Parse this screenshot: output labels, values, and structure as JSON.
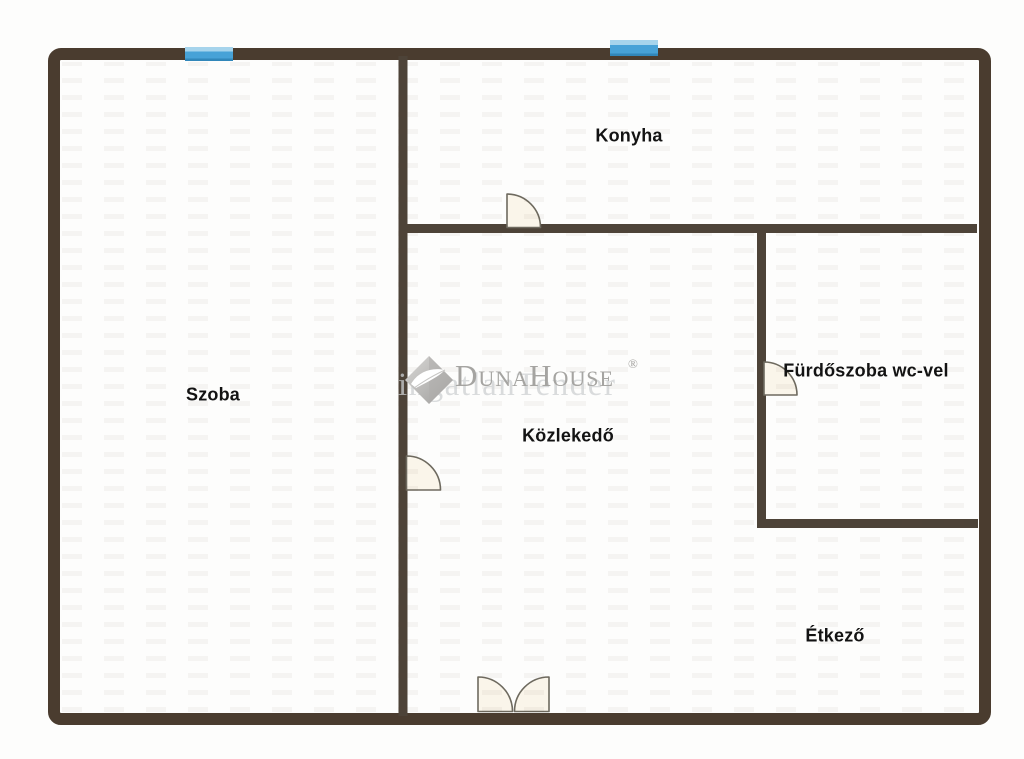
{
  "floor_plan": {
    "rooms": [
      {
        "name": "Szoba"
      },
      {
        "name": "Konyha"
      },
      {
        "name": "Közlekedő"
      },
      {
        "name": "Fürdőszoba wc-vel"
      },
      {
        "name": "Étkező"
      }
    ],
    "features": {
      "windows": 2,
      "single_doors": 3,
      "double_doors": 1
    }
  },
  "watermark": {
    "brand": "DunaHouse",
    "registered_mark": "®",
    "echo_text": "ingatlanTender",
    "logo": "diamond-leaf"
  },
  "colors": {
    "outer_wall": "#4a3c2f",
    "interior_wall": "#4d4338",
    "window_blue": "#47a2d7",
    "window_highlight": "#a6d4ec",
    "window_shade": "#3187ba",
    "door_fill": "#faf5ea",
    "door_stroke": "#6e6a5f",
    "label_text": "#131313",
    "watermark_gray": "#a5a4a1",
    "background": "#fdfdfc"
  }
}
